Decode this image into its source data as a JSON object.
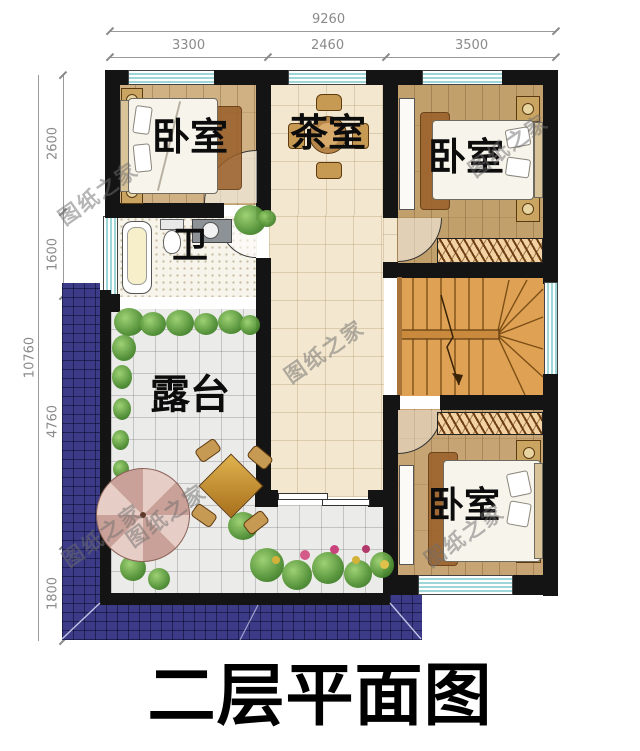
{
  "title": "二层平面图",
  "watermark": "图纸之家",
  "dims": {
    "top": {
      "overall": "9260",
      "segments": [
        "3300",
        "2460",
        "3500"
      ]
    },
    "left": {
      "overall": "10760",
      "segments": [
        "2600",
        "1600",
        "4760",
        "1800"
      ]
    }
  },
  "rooms": {
    "bedroom_tl": "卧室",
    "tea_room": "茶室",
    "bedroom_tr": "卧室",
    "bath": "卫",
    "terrace": "露台",
    "bedroom_br": "卧室"
  },
  "colors": {
    "wall": "#141414",
    "window_stripe": "#9fd6d8",
    "roof_tile": "#3b3b88",
    "wood_floor": "#c9a571",
    "hall_tile": "#f3e7cf",
    "terrace_tile": "#ebebe9",
    "stair_wood": "#dfa254",
    "title_text": "#000000",
    "dimension_text": "#8a8a8a"
  }
}
